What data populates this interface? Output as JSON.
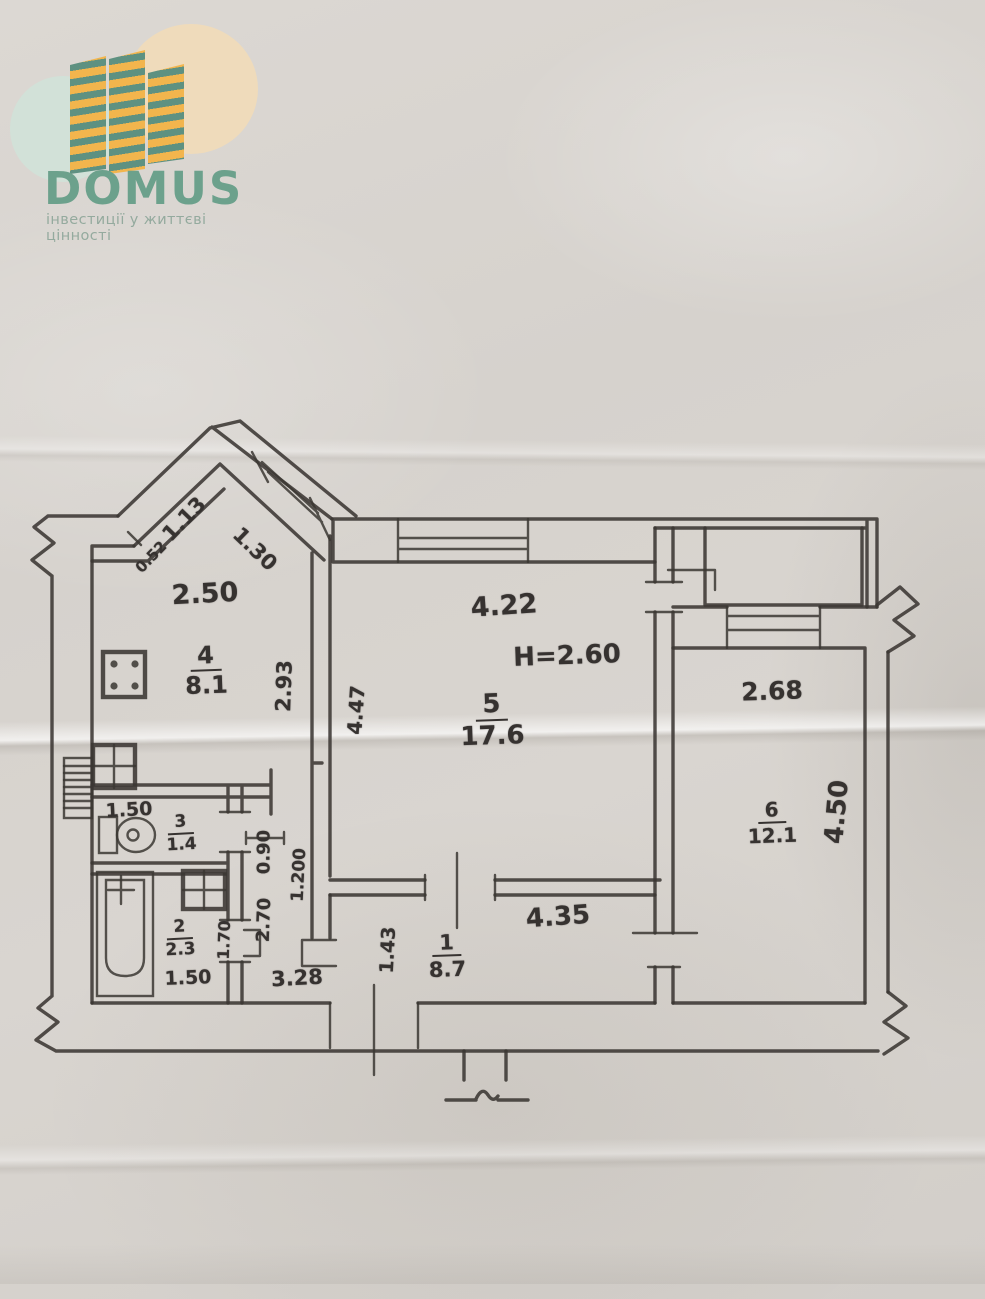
{
  "logo": {
    "brand": "DOMUS",
    "tagline": "інвестиції у життєві цінності",
    "colors": {
      "paper": "#d8d4cf",
      "ink": "#3b3733",
      "brand_green": "#6ca18c",
      "tagline_green": "#94aa9e",
      "tower_yellow": "#f2b54d",
      "tower_green": "#5e9181",
      "circle_mint": "#cfe4d9",
      "circle_peach": "#f4dcb5"
    }
  },
  "floor_plan": {
    "type": "apartment floor plan (hand-drawn BTI sketch)",
    "ceiling_height_note": "H=2.60",
    "rooms": [
      {
        "number": "1",
        "area_m2": "8.7"
      },
      {
        "number": "2",
        "area_m2": "2.3"
      },
      {
        "number": "3",
        "area_m2": "1.4"
      },
      {
        "number": "4",
        "area_m2": "8.1"
      },
      {
        "number": "5",
        "area_m2": "17.6"
      },
      {
        "number": "6",
        "area_m2": "12.1"
      }
    ],
    "labels": [
      {
        "type": "room",
        "name": "room-4-label",
        "number": "4",
        "area": "8.1",
        "x": 206,
        "y": 671,
        "fs": 24,
        "rot": -2
      },
      {
        "type": "room",
        "name": "room-5-label",
        "number": "5",
        "area": "17.6",
        "x": 492,
        "y": 721,
        "fs": 26,
        "rot": -2
      },
      {
        "type": "room",
        "name": "room-6-label",
        "number": "6",
        "area": "12.1",
        "x": 772,
        "y": 823,
        "fs": 20,
        "rot": -2
      },
      {
        "type": "room",
        "name": "room-3-label",
        "number": "3",
        "area": "1.4",
        "x": 181,
        "y": 834,
        "fs": 17,
        "rot": -3
      },
      {
        "type": "room",
        "name": "room-2-label",
        "number": "2",
        "area": "2.3",
        "x": 180,
        "y": 939,
        "fs": 17,
        "rot": -3
      },
      {
        "type": "room",
        "name": "room-1-label",
        "number": "1",
        "area": "8.7",
        "x": 447,
        "y": 956,
        "fs": 21,
        "rot": -2
      },
      {
        "type": "dim",
        "name": "dim-kitchen-width",
        "text": "2.50",
        "x": 205,
        "y": 594,
        "fs": 27,
        "rot": -3
      },
      {
        "type": "dim",
        "name": "dim-diagonal-small",
        "text": "0.52",
        "x": 151,
        "y": 557,
        "fs": 15,
        "rot": -46
      },
      {
        "type": "dim",
        "name": "dim-diagonal-left",
        "text": "1.13",
        "x": 184,
        "y": 519,
        "fs": 21,
        "rot": -46
      },
      {
        "type": "dim",
        "name": "dim-diagonal-window",
        "text": "1.30",
        "x": 255,
        "y": 549,
        "fs": 21,
        "rot": 44
      },
      {
        "type": "dim",
        "name": "dim-room5-width",
        "text": "4.22",
        "x": 504,
        "y": 606,
        "fs": 27,
        "rot": -4
      },
      {
        "type": "dim",
        "name": "note-ceiling-height",
        "text": "H=2.60",
        "x": 567,
        "y": 656,
        "fs": 26,
        "rot": -2
      },
      {
        "type": "dim",
        "name": "dim-room5-depth",
        "text": "4.47",
        "x": 356,
        "y": 710,
        "fs": 20,
        "rot": -86
      },
      {
        "type": "dim",
        "name": "dim-kitchen-depth",
        "text": "2.93",
        "x": 284,
        "y": 686,
        "fs": 21,
        "rot": -88
      },
      {
        "type": "dim",
        "name": "dim-room6-width",
        "text": "2.68",
        "x": 772,
        "y": 691,
        "fs": 25,
        "rot": -2
      },
      {
        "type": "dim",
        "name": "dim-room6-depth",
        "text": "4.50",
        "x": 837,
        "y": 812,
        "fs": 26,
        "rot": -85
      },
      {
        "type": "dim",
        "name": "dim-wc-width",
        "text": "1.50",
        "x": 129,
        "y": 810,
        "fs": 19,
        "rot": -3
      },
      {
        "type": "dim",
        "name": "dim-hall-width",
        "text": "0.90",
        "x": 264,
        "y": 852,
        "fs": 18,
        "rot": -90
      },
      {
        "type": "dim",
        "name": "dim-hall-length",
        "text": "1.200",
        "x": 299,
        "y": 875,
        "fs": 17,
        "rot": -87
      },
      {
        "type": "dim",
        "name": "dim-hall-depth",
        "text": "2.70",
        "x": 264,
        "y": 920,
        "fs": 18,
        "rot": -88
      },
      {
        "type": "dim",
        "name": "dim-bath-door",
        "text": "1.70",
        "x": 224,
        "y": 940,
        "fs": 16,
        "rot": -88
      },
      {
        "type": "dim",
        "name": "dim-bath-width",
        "text": "1.50",
        "x": 188,
        "y": 978,
        "fs": 19,
        "rot": -2
      },
      {
        "type": "dim",
        "name": "dim-corridor-left",
        "text": "3.28",
        "x": 297,
        "y": 978,
        "fs": 21,
        "rot": -3
      },
      {
        "type": "dim",
        "name": "dim-corridor-height",
        "text": "1.43",
        "x": 388,
        "y": 950,
        "fs": 19,
        "rot": -87
      },
      {
        "type": "dim",
        "name": "dim-corridor-width",
        "text": "4.35",
        "x": 558,
        "y": 917,
        "fs": 26,
        "rot": -4
      }
    ]
  }
}
